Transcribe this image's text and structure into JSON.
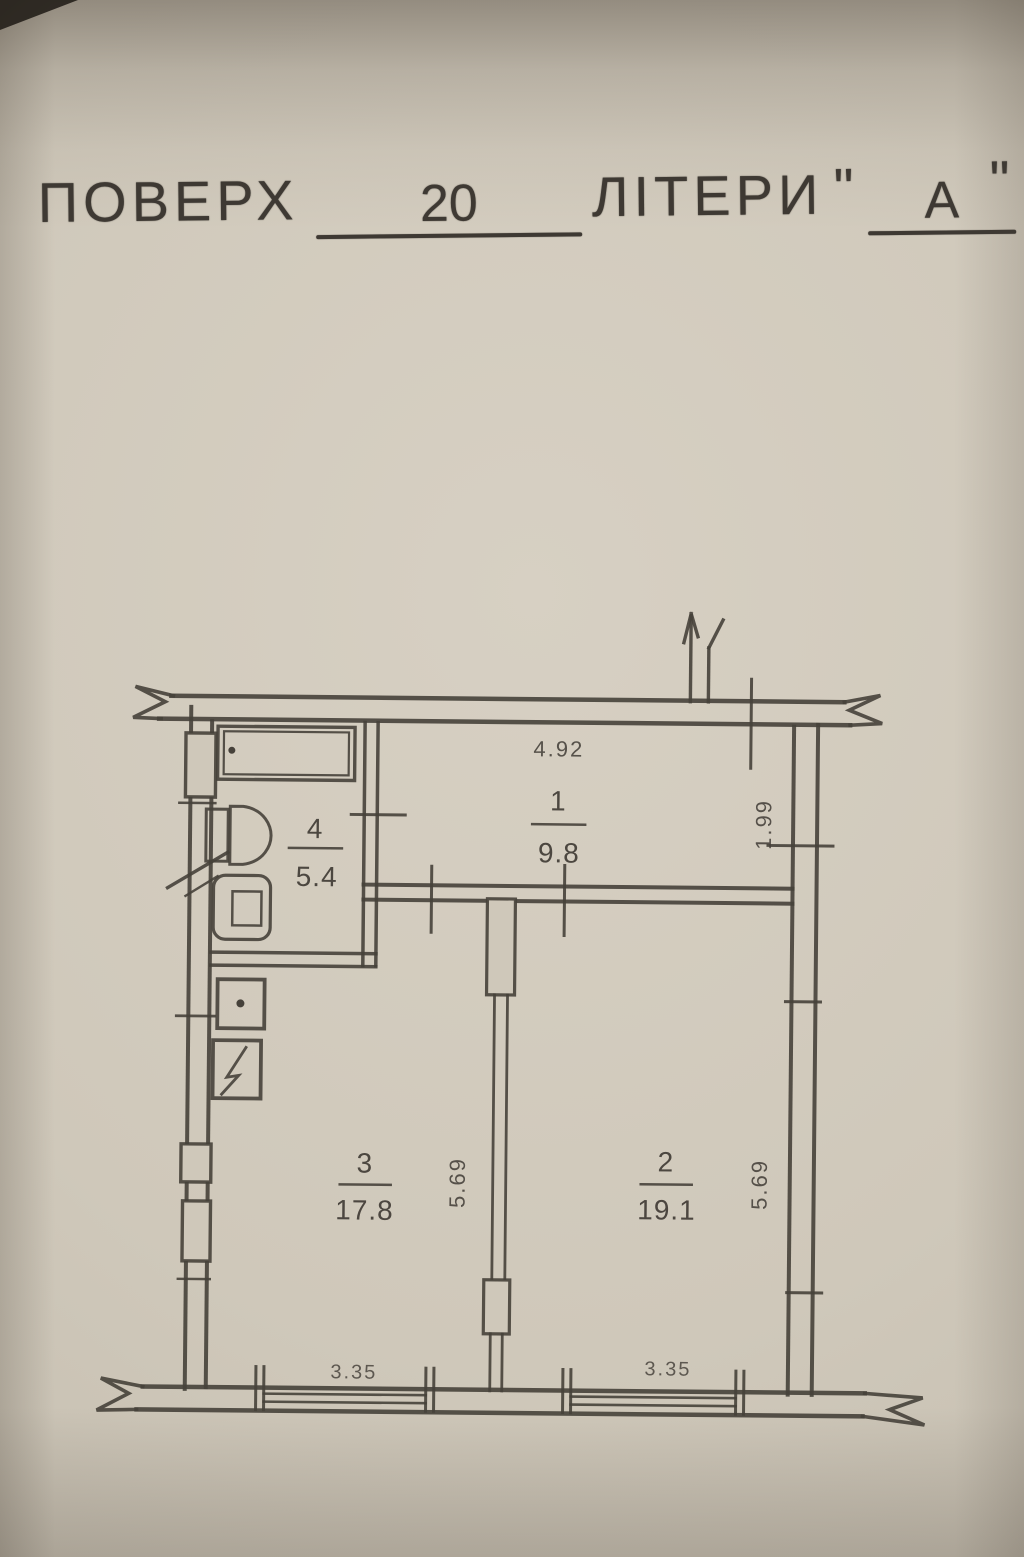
{
  "document": {
    "title": {
      "floor_label": "ПОВЕРХ",
      "floor_value": "20",
      "letters_label": "ЛІТЕРИ",
      "quote_open": "\"",
      "letters_value": "А",
      "quote_close": "\""
    }
  },
  "plan": {
    "rooms": {
      "r1": {
        "number": "1",
        "area": "9.8"
      },
      "r2": {
        "number": "2",
        "area": "19.1"
      },
      "r3": {
        "number": "3",
        "area": "17.8"
      },
      "r4": {
        "number": "4",
        "area": "5.4"
      }
    },
    "dimensions": {
      "hall_width": "4.92",
      "hall_depth": "1.99",
      "room2_height": "5.69",
      "room3_height": "5.69",
      "room2_width": "3.35",
      "room3_width": "3.35"
    }
  },
  "colors": {
    "paper": "#cfc8ba",
    "ink": "#46413a"
  }
}
